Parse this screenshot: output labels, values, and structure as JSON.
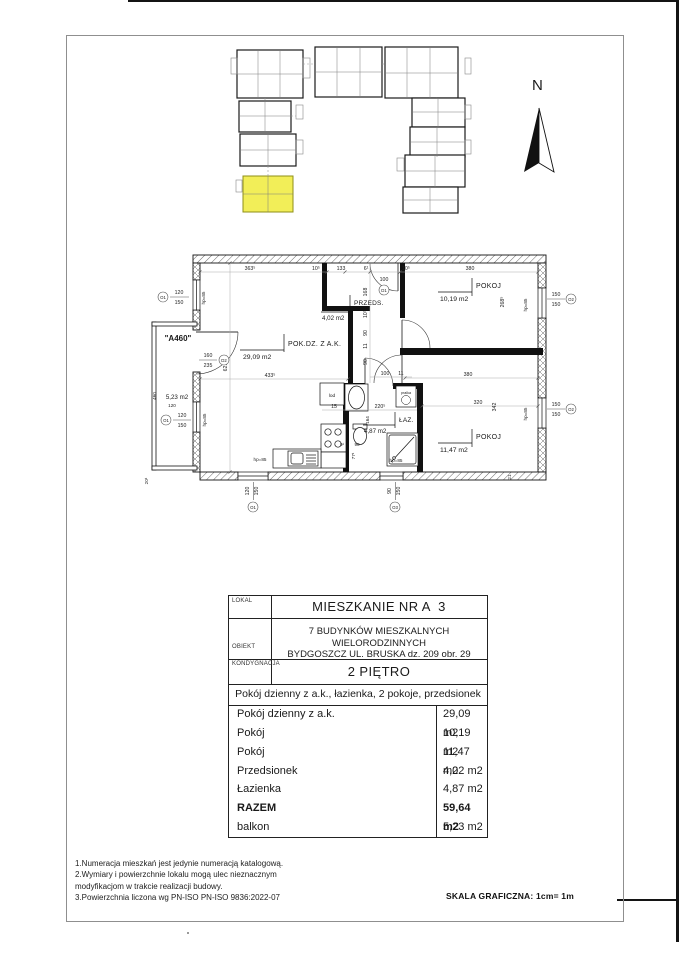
{
  "page": {
    "north_label": "N",
    "scale_note": "SKALA GRAFICZNA: 1cm= 1m"
  },
  "colors": {
    "highlight": "#f2ee58",
    "highlight_border": "#8f8f17"
  },
  "plan": {
    "rooms": {
      "living": {
        "name": "POK.DZ. Z A.K.",
        "area": "29,09 m2"
      },
      "hall": {
        "name": "PRZEDS.",
        "area": "4,02 m2"
      },
      "room1": {
        "name": "POKOJ",
        "area": "10,19 m2"
      },
      "room2": {
        "name": "POKOJ",
        "area": "11,47 m2"
      },
      "bath": {
        "name": "ŁAZ.",
        "area": "4,87 m2"
      },
      "balcony": {
        "name": "\"A460\"",
        "area": "5,23 m2"
      }
    },
    "fixtures": {
      "fridge": "lod",
      "washer": "pralka"
    },
    "dims": {
      "d363": "363⁵",
      "d10a": "10⁵",
      "d133": "133",
      "d6": "6¹",
      "d10b": "10⁵",
      "d380t": "380",
      "d100e": "100",
      "d621": "621",
      "d433": "433⁵",
      "d168": "168",
      "d10c": "10⁵",
      "d90a": "90",
      "d11a": "11",
      "d90b": "90",
      "d100c": "100",
      "d11b": "11",
      "d268": "268⁵",
      "d342": "342",
      "d320": "320",
      "d380b": "380",
      "d15a": "15",
      "d220": "220⁵",
      "d164": "164",
      "d77": "77¹",
      "d9": "9¹",
      "d90c": "90",
      "hp85": "hp=85",
      "d120": "120",
      "d150": "150",
      "d90w": "90",
      "d460": "460",
      "d20": "20¹",
      "d21": "21",
      "d160": "160",
      "d235": "235"
    },
    "markers": {
      "o1": "O1",
      "o2": "O2",
      "o3": "O3",
      "d1": "D1",
      "d2": "D2"
    }
  },
  "table": {
    "lokal_label": "LOKAL",
    "lokal_value": "MIESZKANIE NR A  3",
    "obiekt_label": "OBIEKT",
    "obiekt_line1": "7 BUDYNKÓW MIESZKALNYCH WIELORODZINNYCH",
    "obiekt_line2": "BYDGOSZCZ UL. BRUSKA dz. 209 obr. 29",
    "kondygnacja_label": "KONDYGNACJA",
    "kondygnacja_value": "2 PIĘTRO",
    "description": "Pokój dzienny z a.k., łazienka, 2 pokoje, przedsionek",
    "rows": [
      {
        "label": "Pokój dzienny z a.k.",
        "value": "29,09 m2"
      },
      {
        "label": "Pokój",
        "value": "10,19 m2"
      },
      {
        "label": "Pokój",
        "value": "11,47 m2"
      },
      {
        "label": "Przedsionek",
        "value": "4,02 m2"
      },
      {
        "label": "Łazienka",
        "value": "4,87 m2"
      },
      {
        "label": "RAZEM",
        "value": "59,64 m2"
      },
      {
        "label": "balkon",
        "value": "5,23 m2"
      }
    ]
  },
  "notes": [
    "1.Numeracja mieszkań jest jedynie numeracją katalogową.",
    "2.Wymiary i powierzchnie lokalu mogą ulec nieznacznym",
    "modyfikacjom w trakcie realizacji budowy.",
    "3.Powierzchnia liczona wg PN-ISO PN-ISO 9836:2022-07"
  ]
}
